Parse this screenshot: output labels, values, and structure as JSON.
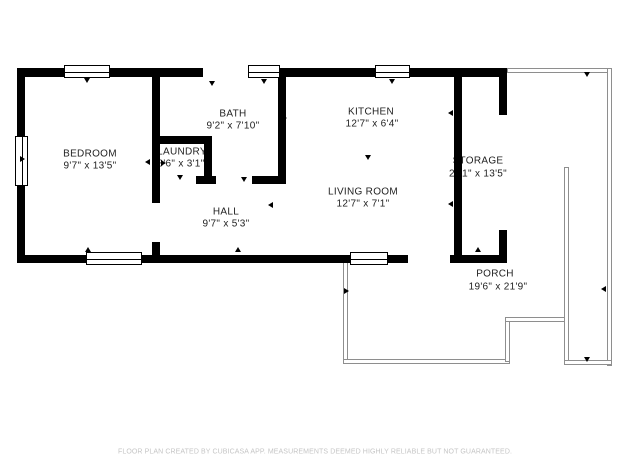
{
  "plan": {
    "rooms": [
      {
        "name": "BEDROOM",
        "dims": "9'7\" x 13'5\""
      },
      {
        "name": "BATH",
        "dims": "9'2\" x 7'10\""
      },
      {
        "name": "LAUNDRY",
        "dims": "3'6\" x 3'1\""
      },
      {
        "name": "HALL",
        "dims": "9'7\" x 5'3\""
      },
      {
        "name": "KITCHEN",
        "dims": "12'7\" x 6'4\""
      },
      {
        "name": "LIVING ROOM",
        "dims": "12'7\" x 7'1\""
      },
      {
        "name": "STORAGE",
        "dims": "2'11\" x 13'5\""
      },
      {
        "name": "PORCH",
        "dims": "19'6\" x 21'9\""
      }
    ],
    "footer": "FLOOR PLAN CREATED BY CUBICASA APP. MEASUREMENTS DEEMED HIGHLY RELIABLE BUT NOT GUARANTEED.",
    "colors": {
      "wall": "#000000",
      "porch_rail": "#8e8e8e",
      "room_text": "#1f1f1f",
      "footer_text": "#c5c5c5",
      "background": "#ffffff"
    }
  }
}
